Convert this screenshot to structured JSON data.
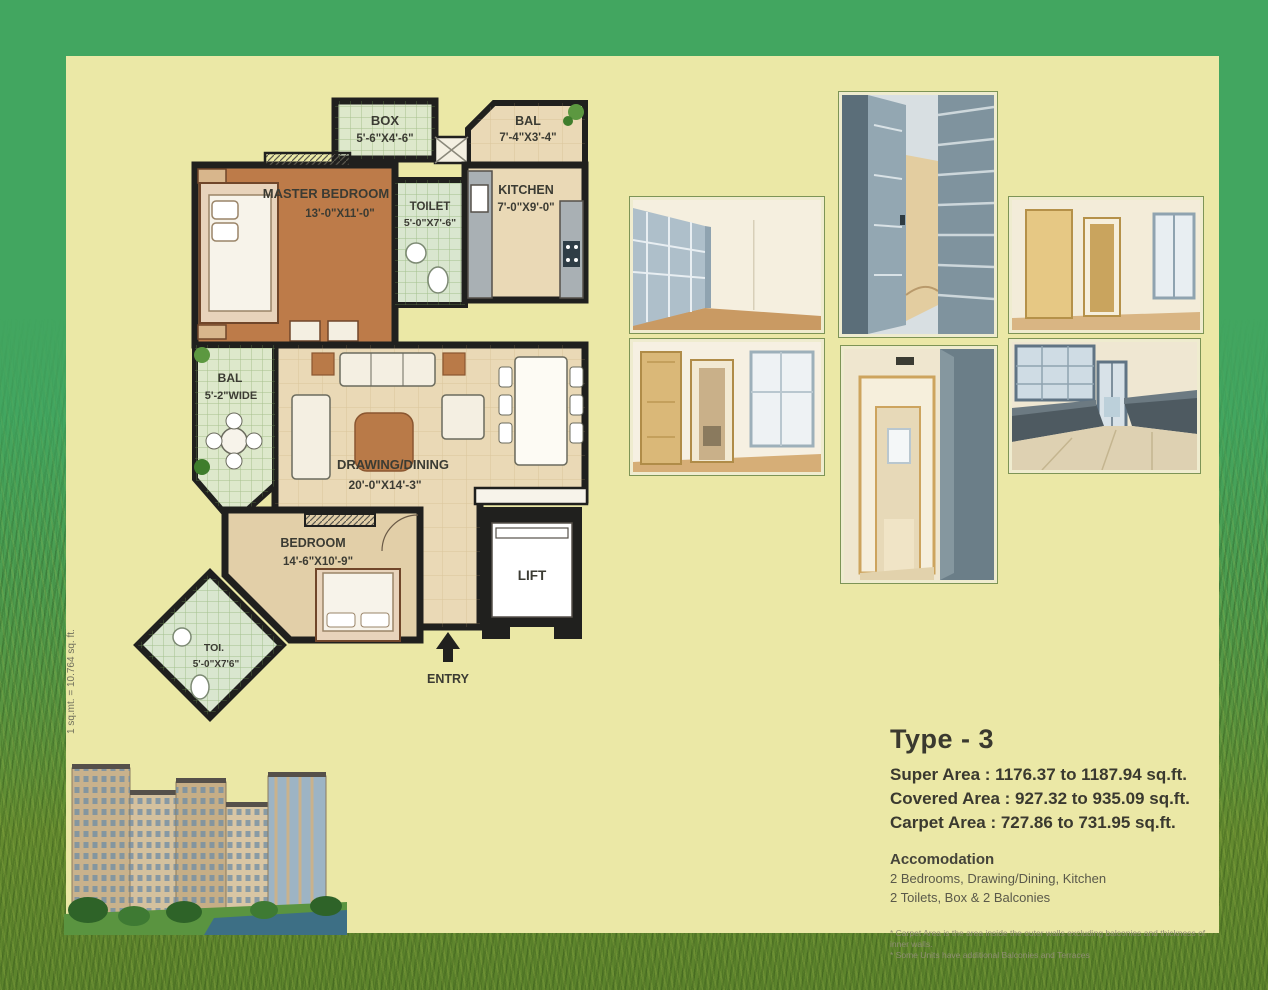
{
  "note_vertical": "1 sq.mt. = 10.764 sq. ft.",
  "plan": {
    "box_label": "BOX",
    "box_dim": "5'-6\"X4'-6\"",
    "bal_top_label": "BAL",
    "bal_top_dim": "7'-4\"X3'-4\"",
    "master_label": "MASTER BEDROOM",
    "master_dim": "13'-0\"X11'-0\"",
    "toilet_label": "TOILET",
    "toilet_dim": "5'-0\"X7'-6\"",
    "kitchen_label": "KITCHEN",
    "kitchen_dim": "7'-0\"X9'-0\"",
    "bal_left_label": "BAL",
    "bal_left_dim": "5'-2\"WIDE",
    "drawing_label": "DRAWING/DINING",
    "drawing_dim": "20'-0\"X14'-3\"",
    "bedroom_label": "BEDROOM",
    "bedroom_dim": "14'-6\"X10'-9\"",
    "toi_label": "TOI.",
    "toi_dim": "5'-0\"X7'6\"",
    "lift_label": "LIFT",
    "entry_label": "ENTRY"
  },
  "specs": {
    "type_title": "Type - 3",
    "super_area": "Super Area : 1176.37 to 1187.94 sq.ft.",
    "covered_area": "Covered Area : 927.32 to 935.09 sq.ft.",
    "carpet_area": "Carpet Area : 727.86 to 731.95 sq.ft.",
    "accommodation_title": "Accomodation",
    "accommodation_line1": "2 Bedrooms, Drawing/Dining, Kitchen",
    "accommodation_line2": "2 Toilets, Box & 2 Balconies",
    "note1": "* Carpet Area is the area inside the outer walls excluding balconies and thickness of inner walls.",
    "note2": "* Some Units have additional Balconies and Terraces"
  },
  "colors": {
    "border_green": "#42a660",
    "panel_cream": "#ebe8a6",
    "plan_floor": "#ead9b6",
    "master_brown": "#bd7b49",
    "tile_green": "#dde8cb",
    "wall_black": "#20201e"
  }
}
